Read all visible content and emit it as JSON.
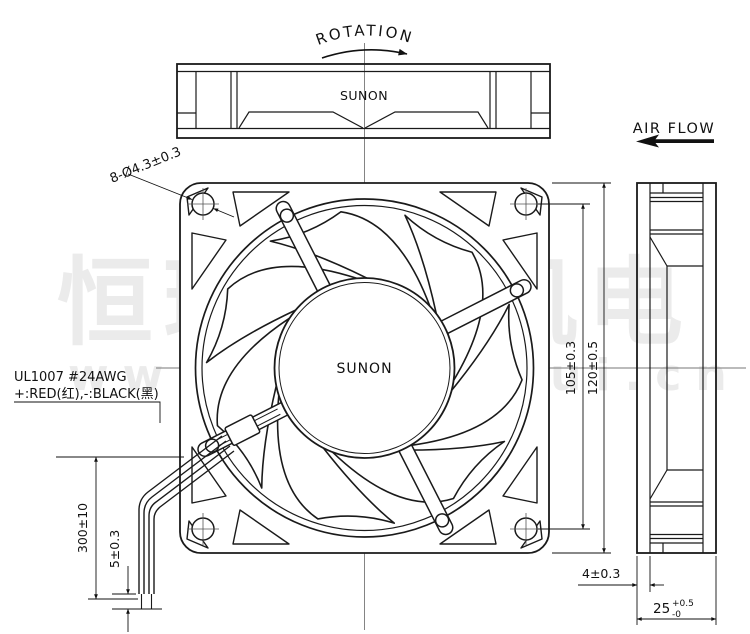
{
  "watermark": {
    "cn": "恒瑞宏晟机电",
    "url": "www.bjhengrui.cn"
  },
  "labels": {
    "rotation": "ROTATION",
    "air_flow": "AIR FLOW",
    "brand": "SUNON",
    "hole_callout": "8-Ø4.3±0.3",
    "wire_spec_line1": "UL1007  #24AWG",
    "wire_spec_line2": "+:RED(红),-:BLACK(黑)"
  },
  "dimensions": {
    "hole_pitch": "105±0.3",
    "frame_size": "120±0.5",
    "lead_length": "300±10",
    "strip_length": "5±0.3",
    "flange_thickness": "4±0.3",
    "depth_nominal": "25",
    "depth_tol_upper": "+0.5",
    "depth_tol_lower": "-0"
  },
  "colors": {
    "line": "#1a1a1a",
    "centerline": "#777777",
    "watermark": "#ebebeb",
    "background": "#ffffff"
  }
}
